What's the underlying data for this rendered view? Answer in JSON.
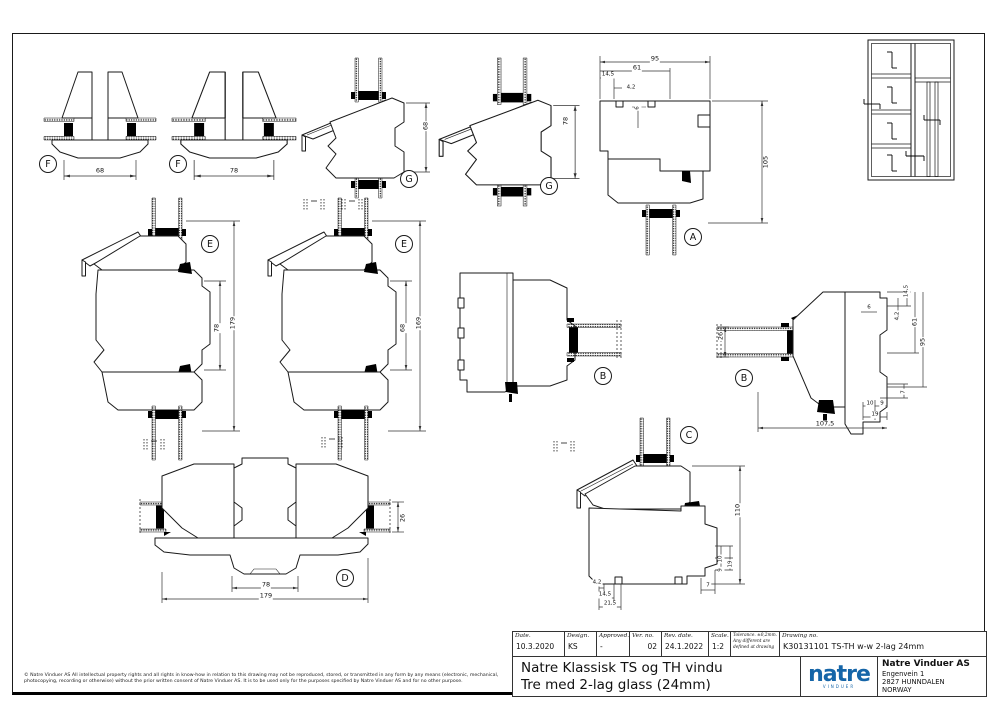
{
  "page": {
    "accent_blue": "#1565a8",
    "line_color": "#1a1a1a"
  },
  "sections": {
    "f1": {
      "label": "F",
      "dim": "68"
    },
    "f2": {
      "label": "F",
      "dim": "78"
    },
    "g1": {
      "label": "G",
      "dim": "68"
    },
    "g2": {
      "label": "G",
      "dim": "78"
    },
    "a": {
      "label": "A",
      "dim_total_w": "95",
      "dim_inner_w": "61",
      "dim_left": "14,5",
      "dim_gap": "4,2",
      "dim_notch": "6",
      "dim_h": "105"
    },
    "e1": {
      "label": "E",
      "dim_inner": "78",
      "dim_total": "179"
    },
    "e2": {
      "label": "E",
      "dim_inner": "68",
      "dim_total": "169"
    },
    "b1": {
      "label": "B"
    },
    "b2": {
      "label": "B",
      "dim_glass": "26",
      "dim_a": "14,5",
      "dim_b": "6",
      "dim_c": "4,2",
      "dim_d": "61",
      "dim_e": "95",
      "dim_f": "7",
      "dim_g": "10",
      "dim_h": "9",
      "dim_i": "19",
      "dim_total": "107,5"
    },
    "c": {
      "label": "C",
      "dim_h": "110",
      "dim_a": "10",
      "dim_b": "19",
      "dim_c": "9",
      "dim_d": "7",
      "dim_e": "4,2",
      "dim_f": "14,5",
      "dim_g": "21,5"
    },
    "d": {
      "label": "D",
      "dim_inner": "78",
      "dim_total": "179",
      "dim_glass": "26"
    }
  },
  "title_block": {
    "fields": [
      {
        "label": "Date.",
        "value": "10.3.2020"
      },
      {
        "label": "Design.",
        "value": "KS"
      },
      {
        "label": "Approved.",
        "value": "-"
      },
      {
        "label": "Ver. no.",
        "value": "02"
      },
      {
        "label": "Rev. date.",
        "value": "24.1.2022"
      },
      {
        "label": "Scale.",
        "value": "1:2"
      }
    ],
    "tolerance_line1": "Tolerance. ±0,2mm.",
    "tolerance_line2": "Any different are",
    "tolerance_line3": "defined at drawing",
    "drawing_no_label": "Drawing no.",
    "drawing_no_value": "K30131101 TS-TH w-w 2-lag 24mm",
    "title_line1": "Natre Klassisk TS og TH vindu",
    "title_line2": "Tre med 2-lag glass (24mm)"
  },
  "company": {
    "logo_text": "natre",
    "logo_sub": "VINDUER",
    "name": "Natre Vinduer AS",
    "address1": "Engenvein 1",
    "address2": "2827 HUNNDALEN",
    "address3": "NORWAY"
  },
  "footer": {
    "copyright_line1": "© Natre Vinduer AS All intellectual property rights and all rights in know-how in relation to this drawing may not be reproduced, stored, or transmitted in any form by any means (electronic, mechanical,",
    "copyright_line2": "photocopying, recording or otherwise) without the prior written consent of Natre Vinduer AS. It is to be used only for the purposes specified by Natre Vinduer AS and for no other purpose."
  }
}
